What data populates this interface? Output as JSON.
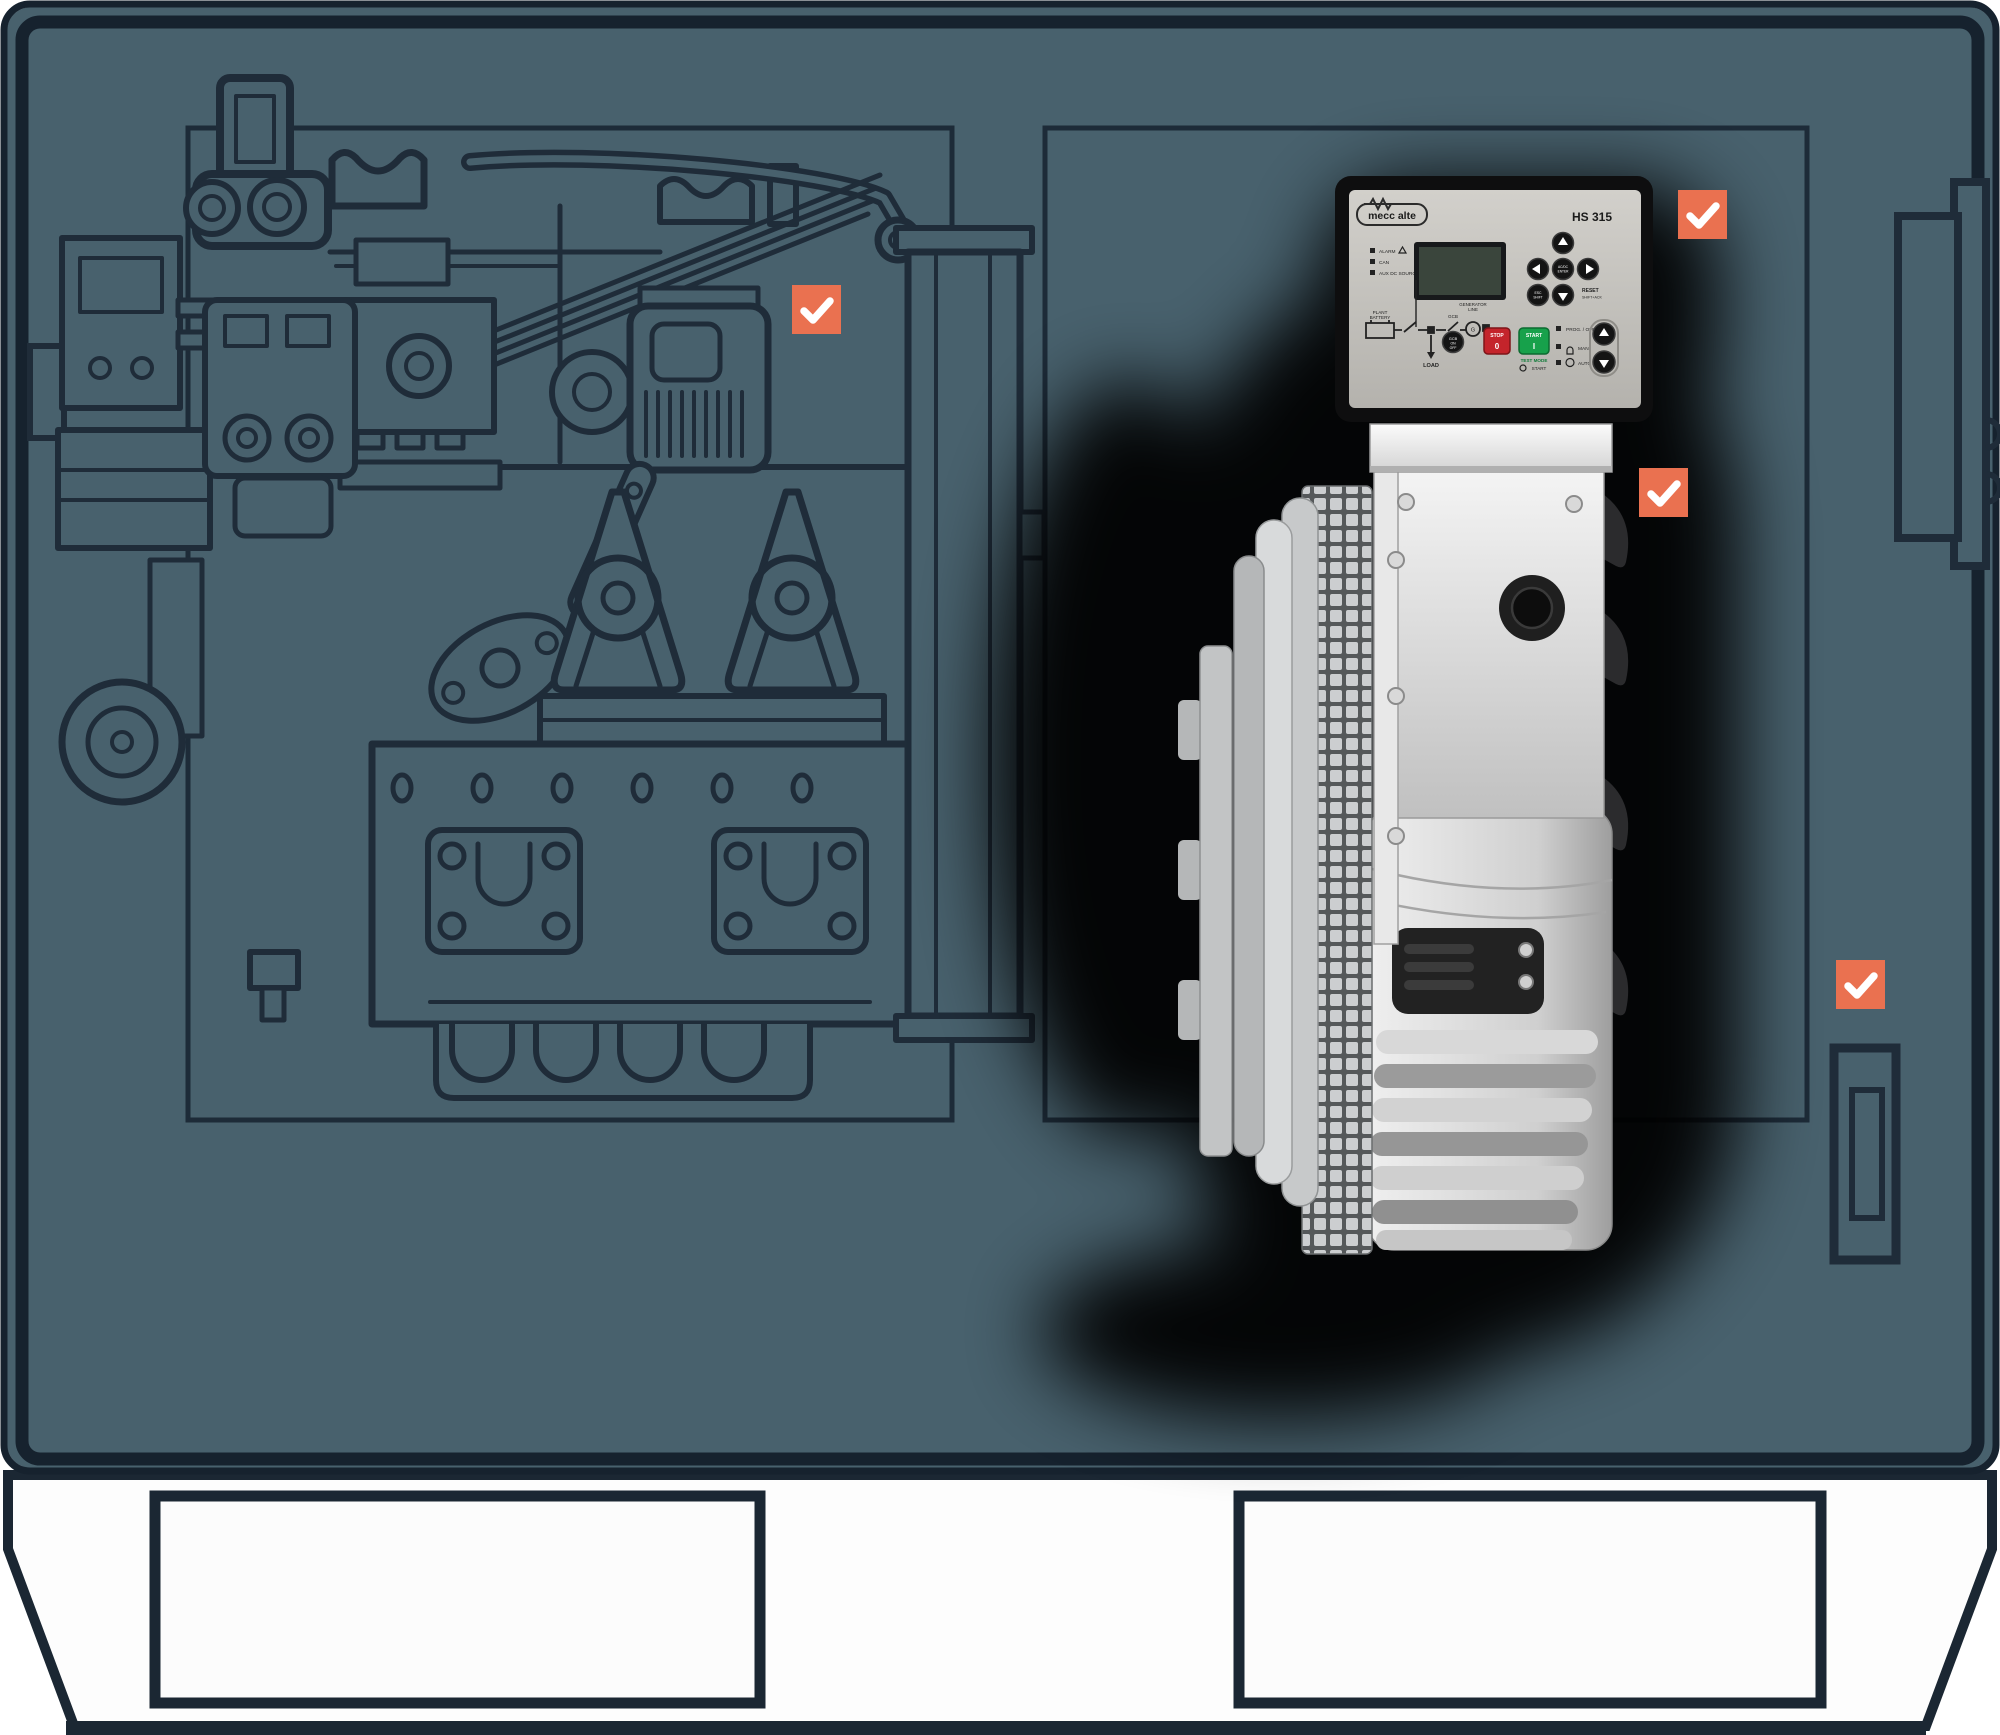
{
  "illustration": {
    "type": "generator-set-cutaway",
    "colors": {
      "canopy": "#48616d",
      "outline": "#1f2c39",
      "frame": "#16222e",
      "accent_orange": "#ea7150",
      "base_white": "#fdfdfd",
      "photo_shadow": "#000000"
    }
  },
  "control_panel": {
    "brand": "mecc alte",
    "model": "HS 315",
    "leds": [
      "ALARM",
      "CAN",
      "AUX DC SOURCE"
    ],
    "mimic": {
      "battery_line1": "PLANT",
      "battery_line2": "BATTERY",
      "load": "LOAD",
      "breaker": "GCB",
      "generator_line1": "GENERATOR",
      "generator_line2": "LINE",
      "generator_symbol": "G",
      "breaker_button_line1": "GCB",
      "breaker_button_line2": "ON",
      "breaker_button_line3": "OFF"
    },
    "buttons": {
      "stop": "STOP",
      "stop_symbol": "0",
      "start": "START",
      "start_symbol": "I",
      "test_mode": "TEST MODE",
      "test_start": "START",
      "esc_line1": "ESC",
      "esc_line2": "SHIFT",
      "enter_line1": "AC/DC",
      "enter_line2": "ENTER",
      "reset": "RESET",
      "reset_sub": "SHIFT+ACK"
    },
    "modes": [
      "PROG. / OFF",
      "MAN.",
      "AUTO / TEST"
    ]
  },
  "checkpoints": {
    "icon": "check",
    "items": [
      {
        "id": "engine"
      },
      {
        "id": "controller"
      },
      {
        "id": "alternator"
      },
      {
        "id": "canopy-side"
      }
    ]
  }
}
